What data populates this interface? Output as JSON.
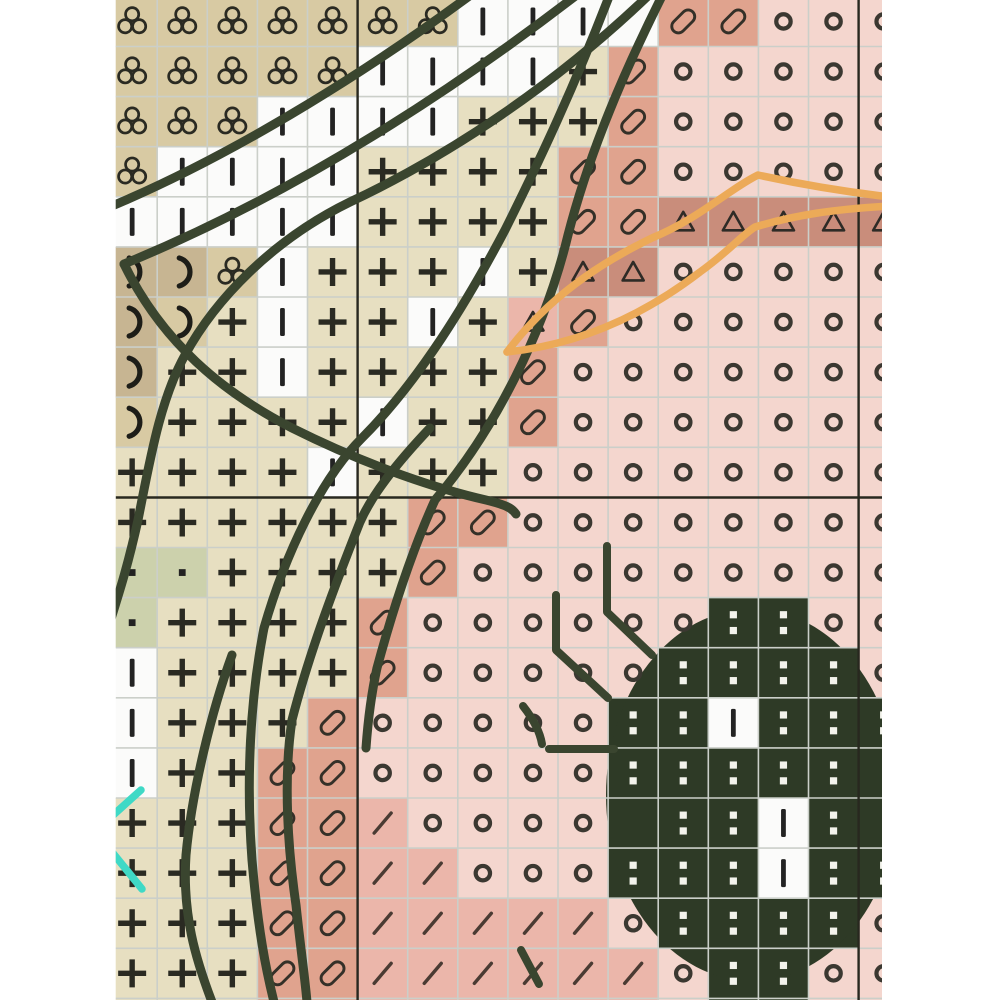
{
  "page": {
    "background": "#ffffff"
  },
  "chart_data": {
    "type": "cross-stitch-grid",
    "description": "Cropped view of a counted cross-stitch chart: symbol grid with backstitch overlays and dark beetle motif at lower right",
    "geometry": {
      "origin_x": 107.1,
      "origin_y": -3.6,
      "cell": 50.1,
      "cols": 16,
      "rows": 20,
      "clip": [
        115.7,
        0,
        766.3,
        1000
      ],
      "major_vlines_x": [
        357.6,
        858.6
      ],
      "major_hlines_y": [
        497.5
      ],
      "bottom_strip_y": 998.4
    },
    "palette": {
      "T": "#d8caa3",
      "K": "#e7dfc1",
      "D": "#c7b592",
      "G": "#ccd1ac",
      "W": "#fbfbfa",
      "S": "#e0a38e",
      "R": "#c98d7b",
      "P": "#f4d6ce",
      "M": "#ebb6aa",
      "B": "#2e3a26",
      "I": "#fbfbfa"
    },
    "symbol_colors": {
      "dark": "#2a2a22",
      "circle": "#3b3831",
      "capsule": "#343028",
      "slash": "#4a3b33",
      "colon": "#f3f3ec"
    },
    "symbols_legend": {
      "c": "club-trefoil",
      "b": "vertical-bar",
      "p": "plus",
      "m": "moon-paren",
      "d": "small-dot",
      "o": "ring",
      "C": "tilted-capsule",
      "s": "slash",
      "t": "triangle",
      "i": "white-colon-on-dark",
      "w": "white-cell-bar",
      "x": "empty"
    },
    "grid_rows": [
      [
        "cT",
        "cT",
        "cT",
        "cT",
        "cT",
        "cT",
        "cT",
        "bW",
        "bW",
        "bW",
        "xW",
        "CS",
        "CS",
        "oP",
        "oP",
        "oP"
      ],
      [
        "cT",
        "cT",
        "cT",
        "cT",
        "cT",
        "bW",
        "bW",
        "bW",
        "bW",
        "pK",
        "CS",
        "oP",
        "oP",
        "oP",
        "oP",
        "oP"
      ],
      [
        "cT",
        "cT",
        "cT",
        "bW",
        "bW",
        "bW",
        "bW",
        "pK",
        "pK",
        "pK",
        "CS",
        "oP",
        "oP",
        "oP",
        "oP",
        "oP"
      ],
      [
        "cT",
        "bW",
        "bW",
        "bW",
        "bW",
        "pK",
        "pK",
        "pK",
        "pK",
        "CS",
        "CS",
        "oP",
        "oP",
        "oP",
        "oP",
        "oP"
      ],
      [
        "bW",
        "bW",
        "bW",
        "bW",
        "bW",
        "pK",
        "pK",
        "pK",
        "pK",
        "CS",
        "CS",
        "tR",
        "tR",
        "tR",
        "tR",
        "tR"
      ],
      [
        "mD",
        "mD",
        "cT",
        "bW",
        "pK",
        "pK",
        "pK",
        "bW",
        "pK",
        "tR",
        "tR",
        "oP",
        "oP",
        "oP",
        "oP",
        "oP"
      ],
      [
        "mD",
        "mT",
        "pK",
        "bW",
        "pK",
        "pK",
        "bW",
        "pK",
        "tM",
        "CS",
        "oP",
        "oP",
        "oP",
        "oP",
        "oP",
        "oP"
      ],
      [
        "mD",
        "pK",
        "pK",
        "bW",
        "pK",
        "pK",
        "pK",
        "pK",
        "CS",
        "oP",
        "oP",
        "oP",
        "oP",
        "oP",
        "oP",
        "oP"
      ],
      [
        "mT",
        "pK",
        "pK",
        "pK",
        "pK",
        "bW",
        "pK",
        "pK",
        "CS",
        "oP",
        "oP",
        "oP",
        "oP",
        "oP",
        "oP",
        "oP"
      ],
      [
        "pK",
        "pK",
        "pK",
        "pK",
        "bW",
        "pK",
        "pK",
        "pK",
        "oP",
        "oP",
        "oP",
        "oP",
        "oP",
        "oP",
        "oP",
        "oP"
      ],
      [
        "pK",
        "pK",
        "pK",
        "pK",
        "pK",
        "pK",
        "CS",
        "CS",
        "oP",
        "oP",
        "oP",
        "oP",
        "oP",
        "oP",
        "oP",
        "oP"
      ],
      [
        "dG",
        "dG",
        "pK",
        "pK",
        "pK",
        "pK",
        "CS",
        "oP",
        "oP",
        "oP",
        "oP",
        "oP",
        "oP",
        "oP",
        "oP",
        "oP"
      ],
      [
        "dG",
        "pK",
        "pK",
        "pK",
        "pK",
        "CS",
        "oP",
        "oP",
        "oP",
        "oP",
        "oP",
        "oP",
        "iB",
        "iB",
        "oP",
        "oP"
      ],
      [
        "bW",
        "pK",
        "pK",
        "pK",
        "pK",
        "CS",
        "oP",
        "oP",
        "oP",
        "oP",
        "oP",
        "iB",
        "iB",
        "iB",
        "iB",
        "oP"
      ],
      [
        "bW",
        "pK",
        "pK",
        "pK",
        "CS",
        "oP",
        "oP",
        "oP",
        "oP",
        "oP",
        "iB",
        "iB",
        "wI",
        "iB",
        "iB",
        "iB"
      ],
      [
        "bW",
        "pK",
        "pK",
        "CS",
        "CS",
        "oP",
        "oP",
        "oP",
        "oP",
        "oP",
        "iB",
        "iB",
        "iB",
        "iB",
        "iB",
        "xB"
      ],
      [
        "pK",
        "pK",
        "pK",
        "CS",
        "CS",
        "sM",
        "oP",
        "oP",
        "oP",
        "oP",
        "xB",
        "iB",
        "iB",
        "wI",
        "iB",
        "xB"
      ],
      [
        "pK",
        "pK",
        "pK",
        "CS",
        "CS",
        "sM",
        "sM",
        "oP",
        "oP",
        "oP",
        "iB",
        "iB",
        "iB",
        "wI",
        "iB",
        "iB"
      ],
      [
        "pK",
        "pK",
        "pK",
        "CS",
        "CS",
        "sM",
        "sM",
        "sM",
        "sM",
        "sM",
        "oP",
        "iB",
        "iB",
        "iB",
        "iB",
        "oP"
      ],
      [
        "pK",
        "pK",
        "pK",
        "CS",
        "CS",
        "sM",
        "sM",
        "sM",
        "sM",
        "sM",
        "sM",
        "oP",
        "iB",
        "iB",
        "oP",
        "oP"
      ]
    ],
    "bottom_strip": [
      "K",
      "K",
      "K",
      "S",
      "S",
      "M",
      "M",
      "M",
      "M",
      "M",
      "M",
      "P",
      "B",
      "B",
      "P",
      "P"
    ],
    "beetle": {
      "ellipse": {
        "cx": 752,
        "cy": 795,
        "rx": 146,
        "ry": 186,
        "fill": "#2e3a26"
      }
    },
    "gridlines": {
      "minor_color": "#cbcfc9",
      "minor_width": 1.6,
      "major_color": "#28281f",
      "major_width": 2.4
    },
    "backstitch": {
      "dark_color": "#3a452f",
      "dark_width": 9,
      "dark_paths": [
        "M472,-6 C380,62 245,150 112,206",
        "M578,-6 C460,85 300,192 124,264",
        "M124,264 C162,342 222,392 292,428 C372,468 442,490 486,500 C506,505 512,508 516,514",
        "M650,-6 C555,85 450,155 350,202 C272,240 215,300 185,355 C160,400 150,460 138,520 C128,565 120,590 110,622",
        "M663,-6 C625,70 590,150 568,235 C545,330 495,430 435,500 C410,555 390,620 377,668 C371,695 368,720 366,748",
        "M610,-6 C575,85 540,160 505,230 C468,300 420,380 362,438 C320,480 285,555 264,628 C250,700 246,780 252,860 C258,930 266,970 274,1002",
        "M430,428 C395,465 372,495 360,522 C337,580 310,650 292,720 C283,780 288,850 296,905 C301,952 305,978 307,1002",
        "M232,655 C212,710 192,790 186,855 C182,915 196,960 212,1002"
      ],
      "leg_width": 8,
      "leg_paths": [
        "M607,546 L607,612 L652,655",
        "M556,595 L556,650 L608,698",
        "M523,706 C534,720 540,732 542,744",
        "M549,749 L614,749",
        "M521,950 L539,984"
      ],
      "orange_color": "#ecaa58",
      "orange_width": 7.5,
      "orange_paths": [
        "M507,352 C548,298 598,264 652,238 C700,218 728,190 758,175 C790,182 830,190 890,197",
        "M507,352 C575,345 640,318 700,272 C728,252 742,235 755,227 C795,215 835,209 890,206"
      ],
      "cyan_color": "#3fd9c6",
      "cyan_width": 7.5,
      "cyan_paths": [
        "M141,790 L111,817",
        "M112,852 L142,889"
      ]
    }
  }
}
